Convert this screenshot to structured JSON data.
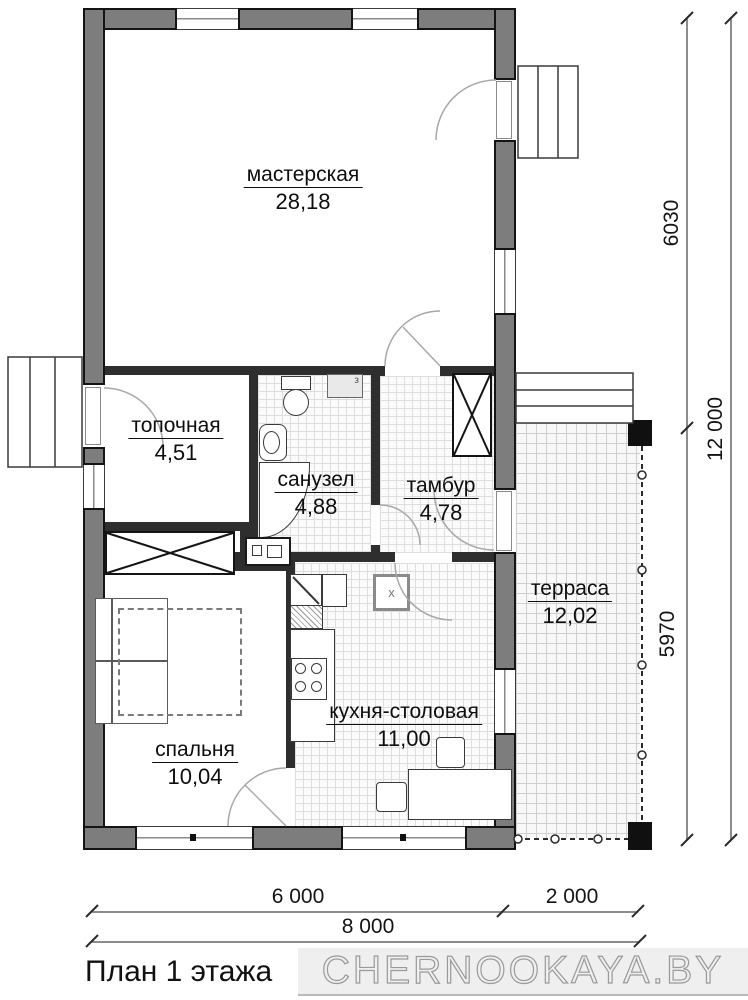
{
  "title": "План 1 этажа",
  "watermark": "CHERNOOKAYA.BY",
  "rooms": {
    "workshop": {
      "name": "мастерская",
      "area": "28,18"
    },
    "boiler": {
      "name": "топочная",
      "area": "4,51"
    },
    "bathroom": {
      "name": "санузел",
      "area": "4,88"
    },
    "vestibule": {
      "name": "тамбур",
      "area": "4,78"
    },
    "terrace": {
      "name": "терраса",
      "area": "12,02"
    },
    "kitchen": {
      "name": "кухня-столовая",
      "area": "11,00"
    },
    "bedroom": {
      "name": "спальня",
      "area": "10,04"
    }
  },
  "dimensions": {
    "vertical": {
      "upper": "6030",
      "lower": "5970",
      "total": "12 000"
    },
    "horizontal": {
      "left": "6 000",
      "right": "2 000",
      "total": "8 000"
    }
  },
  "markers": {
    "water_heater": "з",
    "fridge": "x"
  },
  "colors": {
    "wall": "#7d7d7d",
    "wall_outline": "#141414",
    "interior_wall": "#2e2e2e",
    "dimension_text": "#141414",
    "watermark": "#9a9a9a"
  }
}
